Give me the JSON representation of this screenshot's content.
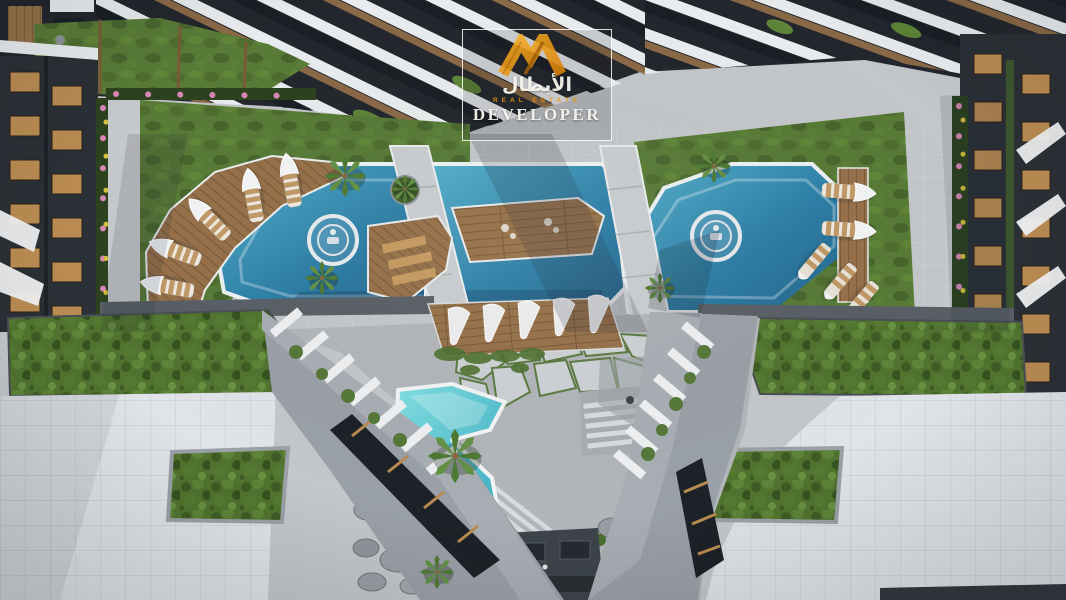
{
  "watermark": {
    "logo_icon": "abtal-monogram-icon",
    "brand_arabic": "الأبطال",
    "tagline": "REAL ESTATE",
    "brand_name": "DEVELOPER"
  },
  "scene": {
    "name": "aerial-courtyard-render",
    "description": "Top-down dusk rendering of a residential complex courtyard: three connected blue swimming pools with circular medallions, wooden sun decks with canopied loungers, cabana pergolas, lawns and flower borders, a turquoise kids pool with palm trees, voronoi paving, stairs, rock garden, roof gardens and white tiled plazas framed by angular apartment buildings.",
    "features": [
      "left pool",
      "center pool with wooden island deck",
      "right pool",
      "pool medallions",
      "canopied sun loungers",
      "cabana row",
      "kids pool",
      "palm trees",
      "roof gardens",
      "tiled plazas",
      "voronoi paving",
      "stairs",
      "rock garden"
    ]
  },
  "css_vars": {
    "--accent": "#e8940f",
    "--pavement": "#c3c7ca",
    "--plaza": "#e0e4e8",
    "--plaza-line": "#c7cdd4",
    "--court": "#b2b6ba",
    "--lawn": "#587b37",
    "--shrub": "#50742f",
    "--wood": "#96714a",
    "--wood-l": "#b98b52",
    "--wood-d": "#6e5234",
    "--bldg-dark": "#2b3036",
    "--bldg-dark2": "#23272d",
    "--bldg-gray": "#9aa0a7",
    "--white-s": "#e9ecee",
    "--fin": "#eef0f2"
  }
}
